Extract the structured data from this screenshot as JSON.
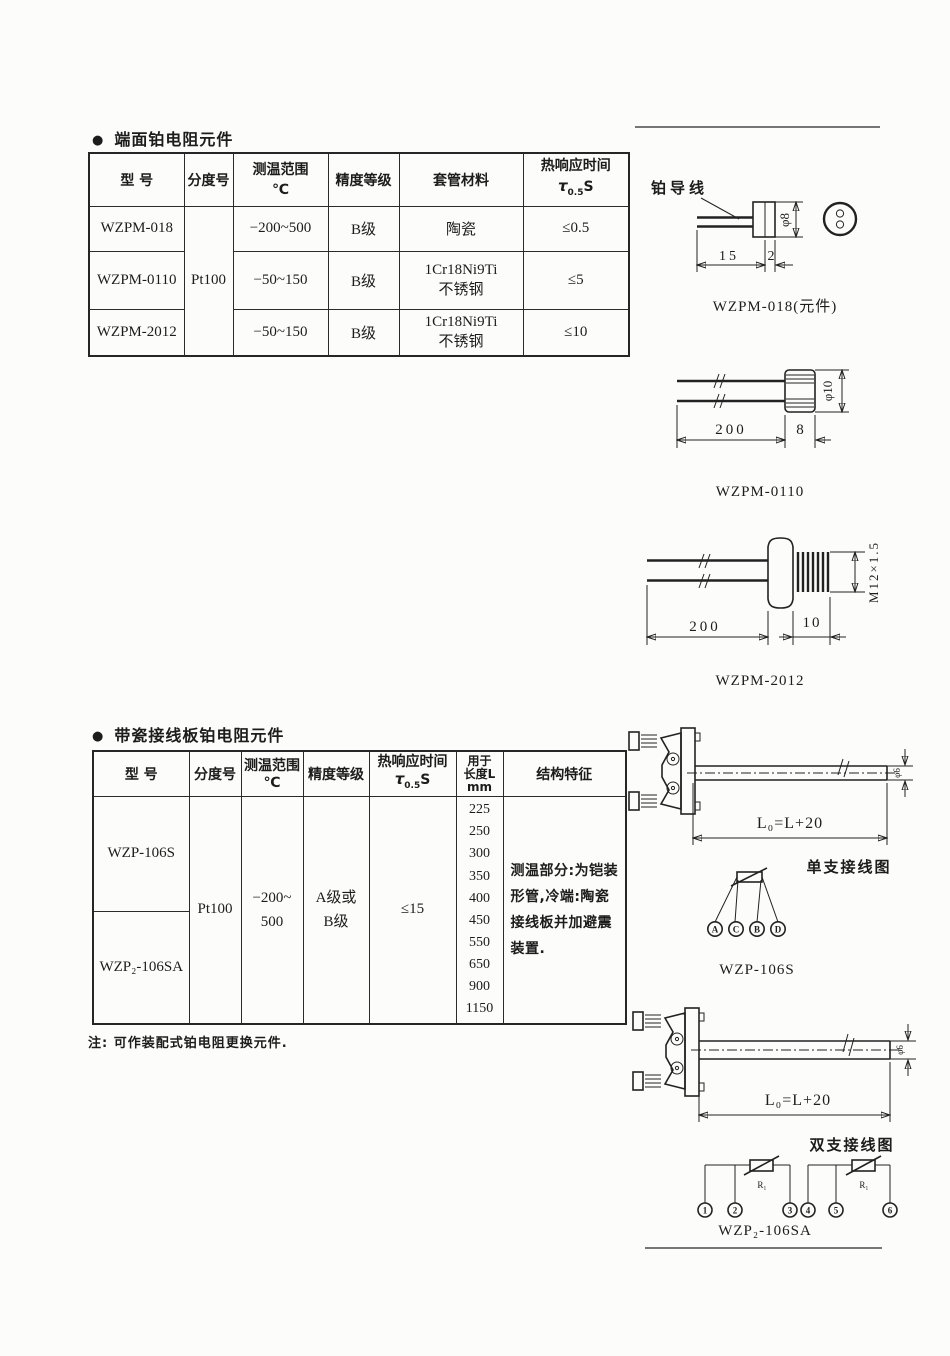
{
  "page": {
    "bullet": "●",
    "section1_title": "端面铂电阻元件",
    "section2_title": "带瓷接线板铂电阻元件",
    "note": "注: 可作装配式铂电阻更换元件."
  },
  "table1": {
    "headers": {
      "model": "型  号",
      "graduation": "分度号",
      "range_line1": "测温范围",
      "range_line2": "℃",
      "accuracy": "精度等级",
      "sheath": "套管材料",
      "response_line1": "热响应时间",
      "tau": "τ",
      "tau_sub": "0.5",
      "tau_unit": "S"
    },
    "graduation_value": "Pt100",
    "rows": [
      {
        "model": "WZPM-018",
        "range": "−200~500",
        "accuracy": "B级",
        "sheath1": "陶瓷",
        "sheath2": "",
        "response": "≤0.5"
      },
      {
        "model": "WZPM-0110",
        "range": "−50~150",
        "accuracy": "B级",
        "sheath1": "1Cr18Ni9Ti",
        "sheath2": "不锈钢",
        "response": "≤5"
      },
      {
        "model": "WZPM-2012",
        "range": "−50~150",
        "accuracy": "B级",
        "sheath1": "1Cr18Ni9Ti",
        "sheath2": "不锈钢",
        "response": "≤10"
      }
    ]
  },
  "table2": {
    "headers": {
      "model": "型  号",
      "graduation": "分度号",
      "range_line1": "测温范围",
      "range_line2": "℃",
      "accuracy": "精度等级",
      "response_line1": "热响应时间",
      "tau": "τ",
      "tau_sub": "0.5",
      "tau_unit": "S",
      "length_line1": "用于",
      "length_line2": "长度L",
      "length_line3": "mm",
      "feature": "结构特征"
    },
    "model1": "WZP-106S",
    "model2": "WZP₂-106SA",
    "graduation_value": "Pt100",
    "range_line1": "−200~",
    "range_line2": "500",
    "accuracy_line1": "A级或",
    "accuracy_line2": "B级",
    "response": "≤15",
    "lengths": [
      "225",
      "250",
      "300",
      "350",
      "400",
      "450",
      "550",
      "650",
      "900",
      "1150"
    ],
    "feature_text": "测温部分:为铠装形管,冷端:陶瓷接线板并加避震装置."
  },
  "diagrams": {
    "wzpm018": {
      "lead_label": "铂导线",
      "dia": "φ8",
      "dim_body": "15",
      "dim_tip": "2",
      "caption": "WZPM-018(元件)"
    },
    "wzpm0110": {
      "dia": "φ10",
      "dim_lead": "200",
      "dim_body": "8",
      "caption": "WZPM-0110"
    },
    "wzpm2012": {
      "thread": "M12×1.5",
      "dim_lead": "200",
      "dim_thread": "10",
      "caption": "WZPM-2012"
    },
    "single": {
      "formula": "L₀=L+20",
      "dia": "φ6",
      "wiring_title": "单支接线图",
      "terminals": [
        "A",
        "C",
        "B",
        "D"
      ],
      "caption": "WZP-106S"
    },
    "double": {
      "formula": "L₀=L+20",
      "dia": "φ6",
      "wiring_title": "双支接线图",
      "r_label": "R₁",
      "terminals": [
        "1",
        "2",
        "3",
        "4",
        "5",
        "6"
      ],
      "caption": "WZP₂-106SA"
    }
  }
}
